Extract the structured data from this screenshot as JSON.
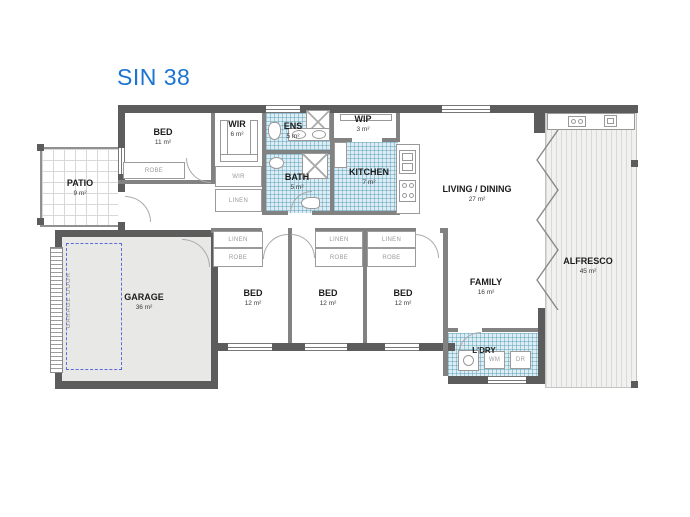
{
  "title": "SIN 38",
  "colors": {
    "title": "#1b74d2",
    "tile": "#dcedf4",
    "garage_door_dash": "#5a6ad8",
    "wall": "#5c5c5c"
  },
  "rooms": {
    "patio": {
      "name": "PATIO",
      "area": "9 m²"
    },
    "bed1": {
      "name": "BED",
      "area": "11 m²"
    },
    "wir": {
      "name": "WIR",
      "area": "6 m²"
    },
    "ens": {
      "name": "ENS",
      "area": "5 m²"
    },
    "wip": {
      "name": "WIP",
      "area": "3 m²"
    },
    "bath": {
      "name": "BATH",
      "area": "5 m²"
    },
    "kitchen": {
      "name": "KITCHEN",
      "area": "7 m²"
    },
    "living": {
      "name": "LIVING / DINING",
      "area": "27 m²"
    },
    "alfresco": {
      "name": "ALFRESCO",
      "area": "45 m²"
    },
    "garage": {
      "name": "GARAGE",
      "area": "36 m²"
    },
    "bed2": {
      "name": "BED",
      "area": "12 m²"
    },
    "bed3": {
      "name": "BED",
      "area": "12 m²"
    },
    "bed4": {
      "name": "BED",
      "area": "12 m²"
    },
    "family": {
      "name": "FAMILY",
      "area": "16 m²"
    },
    "ldry": {
      "name": "L'DRY",
      "area": ""
    }
  },
  "closet_labels": {
    "robe": "ROBE",
    "linen": "LINEN",
    "wir": "WIR"
  },
  "appliance_labels": {
    "washing_machine": "WM",
    "dryer": "DR"
  },
  "garage_door_label": "GARAGE DOOR"
}
